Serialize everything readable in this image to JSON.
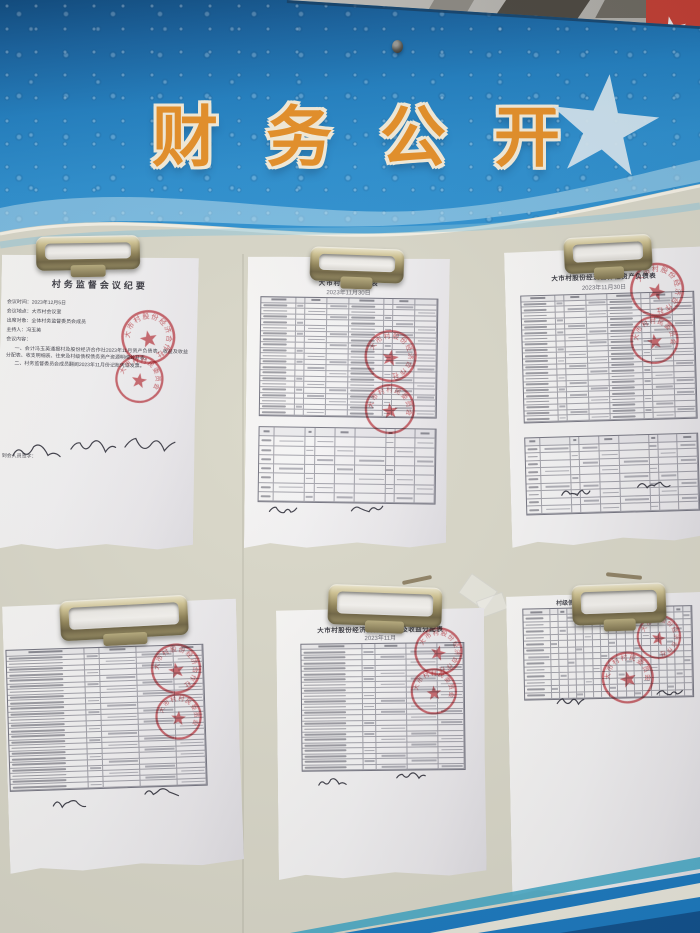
{
  "banner": {
    "title": "财务公开",
    "colors": {
      "blue_dark": "#0c4a80",
      "blue_main": "#1f7fc2",
      "blue_light": "#2f93d3",
      "title_fill": "#e78f25",
      "title_outline": "#f6eedb",
      "star": "#d5e7f1",
      "edge_line": "#123a5e"
    }
  },
  "background": {
    "board_color": "#d9d7c8",
    "top_wall": "#bdbbb6",
    "red_object": "#c23b30",
    "bottom_stripe_teal": "#3aa4c4",
    "bottom_stripe_blue": "#1878bf",
    "bottom_stripe_navy": "#0d4f8c",
    "seal_red": "#c8444c"
  },
  "documents": [
    {
      "id": "meeting-minutes",
      "title": "村务监督会议纪要",
      "lines": [
        "会议时间：2023年12月5日",
        "会议地点：大市村会议室",
        "出席对象：全体村务监督委员会成员",
        "主持人：冯玉英",
        "会议内容：",
        "一、会计冯玉英通报村及股份经济合作社2023年11月资产负债表、收益及收益分配表、收支明细表、往来及村级债权债务资产资源明细公开表。",
        "二、村务监督委员会成员翻阅2023年11月份记账凭证发票。"
      ],
      "footer_label": "到会人员签字：",
      "stamps": [
        {
          "arc_text": "大市村股份经济合作社"
        },
        {
          "arc_text": "大市村村民委员会"
        }
      ]
    },
    {
      "id": "village-balance-sheet",
      "title": "大市村资产负债表",
      "subtitle": "2023年11月30日",
      "stamps": [
        {
          "arc_text": "大市村股份经济合作社"
        },
        {
          "arc_text": "大市村村民委员会"
        }
      ]
    },
    {
      "id": "coop-balance-sheet",
      "title": "大市村股份经济合作社资产负债表",
      "subtitle": "2023年11月30日",
      "stamps": [
        {
          "arc_text": "大市村股份经济合作社"
        },
        {
          "arc_text": "大市村村民委员会"
        }
      ]
    },
    {
      "id": "village-income-statement",
      "title": "大市村收益及收益分配表",
      "subtitle": "2023年11月",
      "stamps": [
        {
          "arc_text": "大市村股份经济合作社"
        },
        {
          "arc_text": "大市村村民委员会"
        }
      ]
    },
    {
      "id": "coop-income-statement",
      "title": "大市村股份经济合作社收益及收益分配表",
      "subtitle": "2023年11月",
      "stamps": [
        {
          "arc_text": "大市村股份经济合作社"
        },
        {
          "arc_text": "大市村村民委员会"
        }
      ]
    },
    {
      "id": "assets-liabilities-detail",
      "title": "村级债权债务及资产资源明细公开表",
      "stamps": [
        {
          "arc_text": "大市村股份经济合作社"
        },
        {
          "arc_text": "大市村村民委员会"
        }
      ]
    }
  ]
}
